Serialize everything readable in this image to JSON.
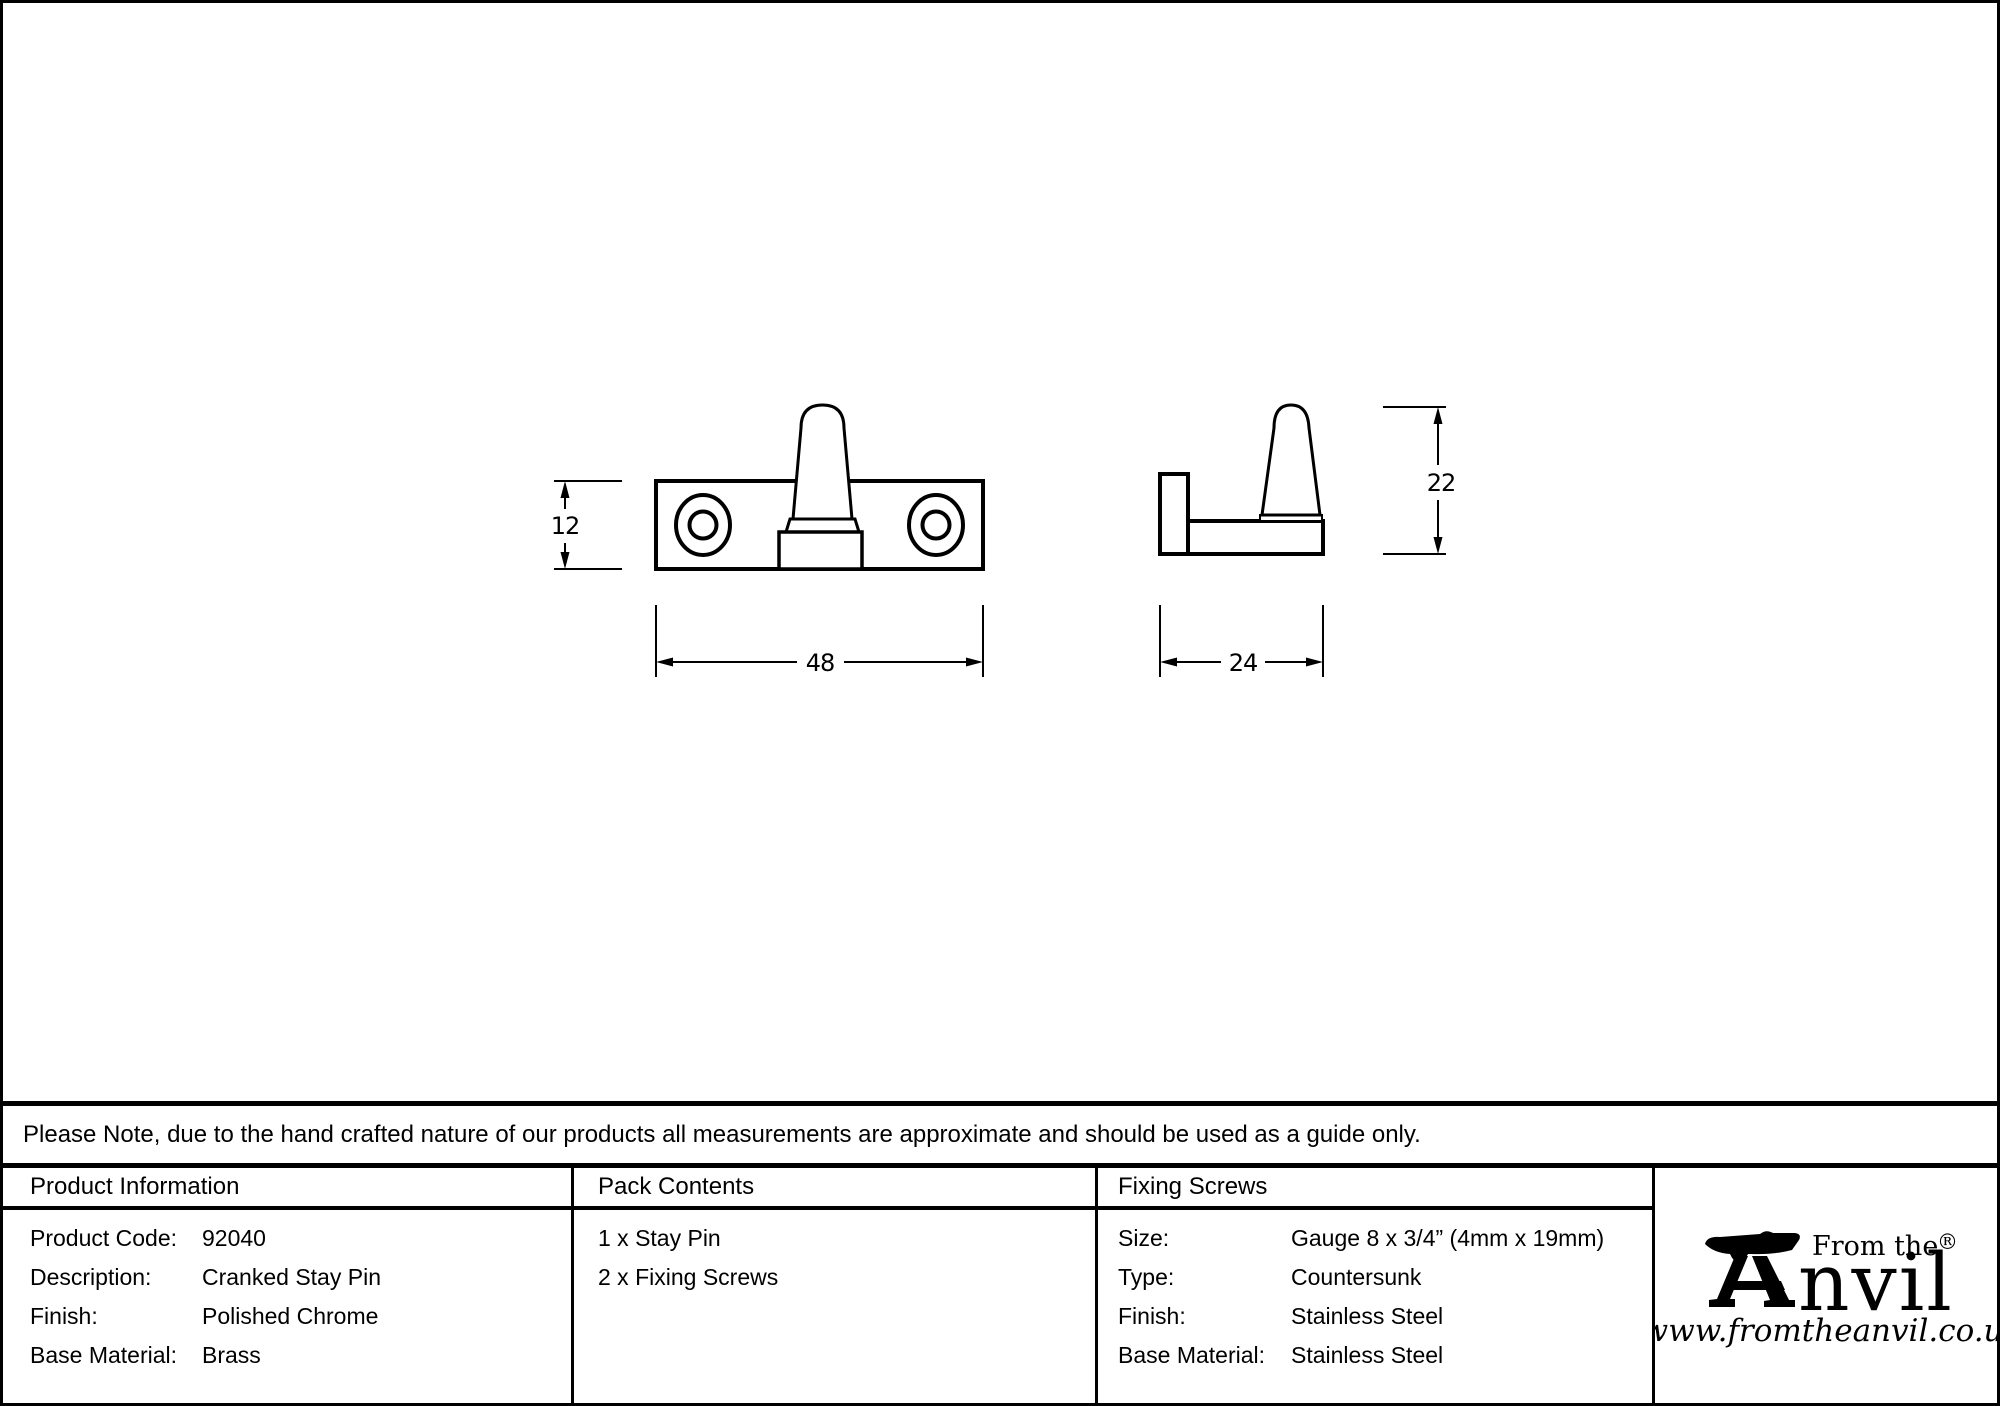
{
  "colors": {
    "ink": "#000000",
    "background": "#ffffff"
  },
  "note": {
    "text": "Please Note, due to the hand crafted nature of our products all measurements are approximate and should be used as a guide only."
  },
  "drawing": {
    "front_view": {
      "height_dim": "12",
      "width_dim": "48"
    },
    "side_view": {
      "height_dim": "22",
      "width_dim": "24"
    }
  },
  "table": {
    "product_information": {
      "title": "Product Information",
      "rows": [
        {
          "label": "Product Code:",
          "value": "92040"
        },
        {
          "label": "Description:",
          "value": "Cranked Stay Pin"
        },
        {
          "label": "Finish:",
          "value": "Polished Chrome"
        },
        {
          "label": "Base Material:",
          "value": "Brass"
        }
      ]
    },
    "pack_contents": {
      "title": "Pack Contents",
      "items": [
        "1 x Stay Pin",
        "2 x Fixing Screws"
      ]
    },
    "fixing_screws": {
      "title": "Fixing Screws",
      "rows": [
        {
          "label": "Size:",
          "value": "Gauge 8 x 3/4” (4mm x 19mm)"
        },
        {
          "label": "Type:",
          "value": "Countersunk"
        },
        {
          "label": "Finish:",
          "value": "Stainless Steel"
        },
        {
          "label": "Base Material:",
          "value": "Stainless Steel"
        }
      ]
    }
  },
  "logo": {
    "tagline": "From the",
    "brand": "Anvil",
    "brand_visible_text": "nvil",
    "registered_mark": "®",
    "website": "www.fromtheanvil.co.uk"
  }
}
